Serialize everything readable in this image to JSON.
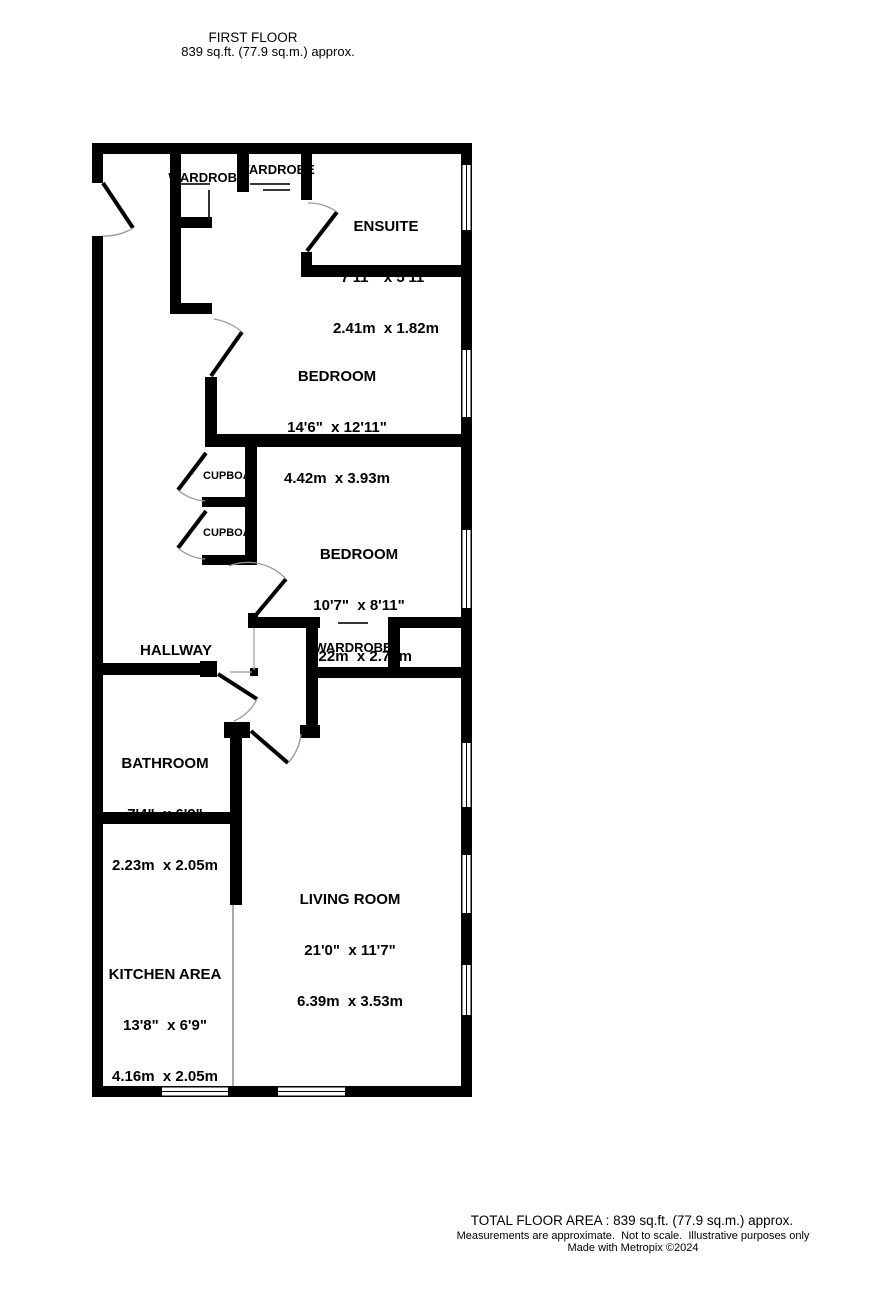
{
  "header": {
    "line1": "FIRST FLOOR",
    "line2": "839 sq.ft. (77.9 sq.m.) approx."
  },
  "rooms": {
    "ensuite": {
      "name": "ENSUITE",
      "imperial": "7'11\"  x 5'11\"",
      "metric": "2.41m  x 1.82m"
    },
    "bedroom1": {
      "name": "BEDROOM",
      "imperial": "14'6\"  x 12'11\"",
      "metric": "4.42m  x 3.93m"
    },
    "bedroom2": {
      "name": "BEDROOM",
      "imperial": "10'7\"  x 8'11\"",
      "metric": "3.22m  x 2.72m"
    },
    "hallway": {
      "name": "HALLWAY"
    },
    "bathroom": {
      "name": "BATHROOM",
      "imperial": "7'4\"  x 6'9\"",
      "metric": "2.23m  x 2.05m"
    },
    "living": {
      "name": "LIVING ROOM",
      "imperial": "21'0\"  x 11'7\"",
      "metric": "6.39m  x 3.53m"
    },
    "kitchen": {
      "name": "KITCHEN AREA",
      "imperial": "13'8\"  x 6'9\"",
      "metric": "4.16m  x 2.05m"
    },
    "wardrobe1": {
      "name": "WARDROBE"
    },
    "wardrobe2": {
      "name": "WARDROBE"
    },
    "wardrobe3": {
      "name": "WARDROBE"
    },
    "cupboard1": {
      "name": "CUPBOARD"
    },
    "cupboard2": {
      "name": "CUPBOARD"
    }
  },
  "footer": {
    "total": "TOTAL FLOOR AREA : 839 sq.ft. (77.9 sq.m.) approx.",
    "disclaimer": "Measurements are approximate.  Not to scale.  Illustrative purposes only",
    "credit": "Made with Metropix ©2024"
  },
  "colors": {
    "wall": "#000000",
    "door_arc": "#999999",
    "divider_line": "#aaaaaa",
    "background": "#ffffff",
    "text": "#000000"
  }
}
